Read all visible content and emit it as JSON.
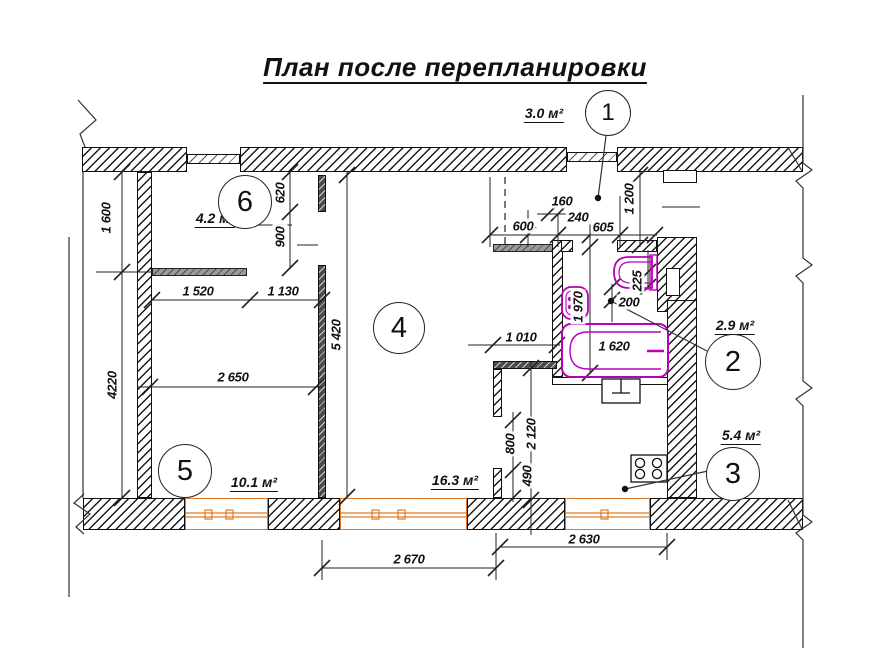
{
  "title": "План после перепланировки",
  "colors": {
    "line": "#1a1a1a",
    "window_accent": "#e07a28",
    "fixture_accent": "#b800b8",
    "dim_text": "#111111"
  },
  "markers": {
    "m1": "1",
    "m2": "2",
    "m3": "3",
    "m4": "4",
    "m5": "5",
    "m6": "6"
  },
  "areas": {
    "a1": "3.0 м²",
    "a2": "2.9 м²",
    "a3": "5.4 м²",
    "a4": "16.3 м²",
    "a5": "10.1 м²",
    "a6": "4.2 м²"
  },
  "dims": {
    "v1600": "1 600",
    "v4220": "4220",
    "v620": "620",
    "v900": "900",
    "v5420": "5 420",
    "v1200": "1 200",
    "v1970": "1 970",
    "v225": "225",
    "v2120": "2 120",
    "v800": "800",
    "v490": "490",
    "h1520": "1 520",
    "h1130": "1 130",
    "h2650": "2 650",
    "h2670": "2 670",
    "h2630": "2 630",
    "h1010": "1 010",
    "h1620": "1 620",
    "h600": "600",
    "h240": "240",
    "h605": "605",
    "h160": "160",
    "h200": "200"
  }
}
